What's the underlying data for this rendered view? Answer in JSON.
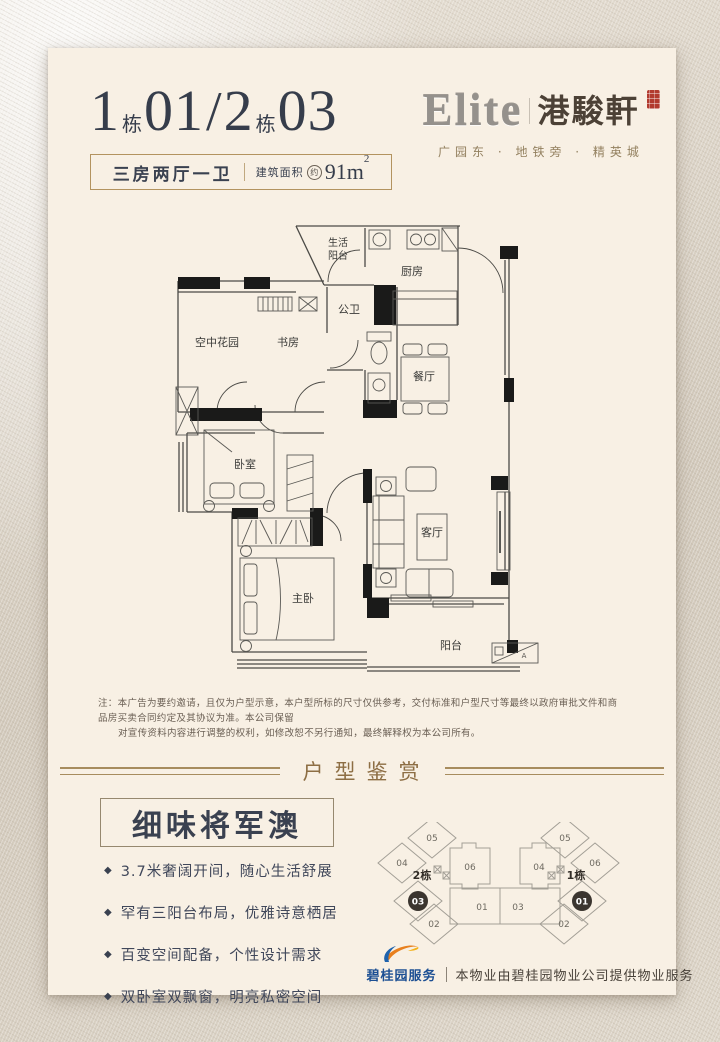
{
  "header": {
    "b1_num": "1",
    "b1_dong": "栋",
    "b1_unit": "01",
    "slash": "/",
    "b2_num": "2",
    "b2_dong": "栋",
    "b2_unit": "03",
    "spec": "三房两厅一卫",
    "area_label": "建筑面积",
    "area_approx": "约",
    "area_value": "91m",
    "area_sup": "2"
  },
  "brand": {
    "logo_en": "Elite",
    "logo_cn": "港駿軒",
    "tagline": "广园东 · 地铁旁 · 精英城"
  },
  "floorplan": {
    "rooms": {
      "laundry_line1": "生活",
      "laundry_line2": "阳台",
      "kitchen": "厨房",
      "bath": "公卫",
      "sky_garden": "空中花园",
      "study": "书房",
      "dining": "餐厅",
      "bedroom": "卧室",
      "master": "主卧",
      "living": "客厅",
      "balcony": "阳台",
      "ac_mark": "A"
    }
  },
  "disclaimer": {
    "line1": "注：本广告为要约邀请，且仅为户型示意，本户型所标的尺寸仅供参考，交付标准和户型尺寸等最终以政府审批文件和商品房买卖合同约定及其协议为准。本公司保留",
    "line2": "对宣传资料内容进行调整的权利，如修改恕不另行通知，最终解释权为本公司所有。"
  },
  "section": {
    "divider_title": "户型鉴赏",
    "heading": "细味将军澳",
    "bullet_icon": "◆",
    "bullets": [
      "3.7米奢阔开间，随心生活舒展",
      "罕有三阳台布局，优雅诗意栖居",
      "百变空间配备，个性设计需求",
      "双卧室双飘窗，明亮私密空间"
    ]
  },
  "siteplan": {
    "left_building": "2栋",
    "right_building": "1栋",
    "left": {
      "u05": "05",
      "u04": "04",
      "u06": "06",
      "u03": "03",
      "u01": "01",
      "u02": "02"
    },
    "right": {
      "u05": "05",
      "u06": "06",
      "u04": "04",
      "u01": "01",
      "u03": "03",
      "u02": "02"
    }
  },
  "footer": {
    "brand": "碧桂园服务",
    "text": "本物业由碧桂园物业公司提供物业服务"
  }
}
